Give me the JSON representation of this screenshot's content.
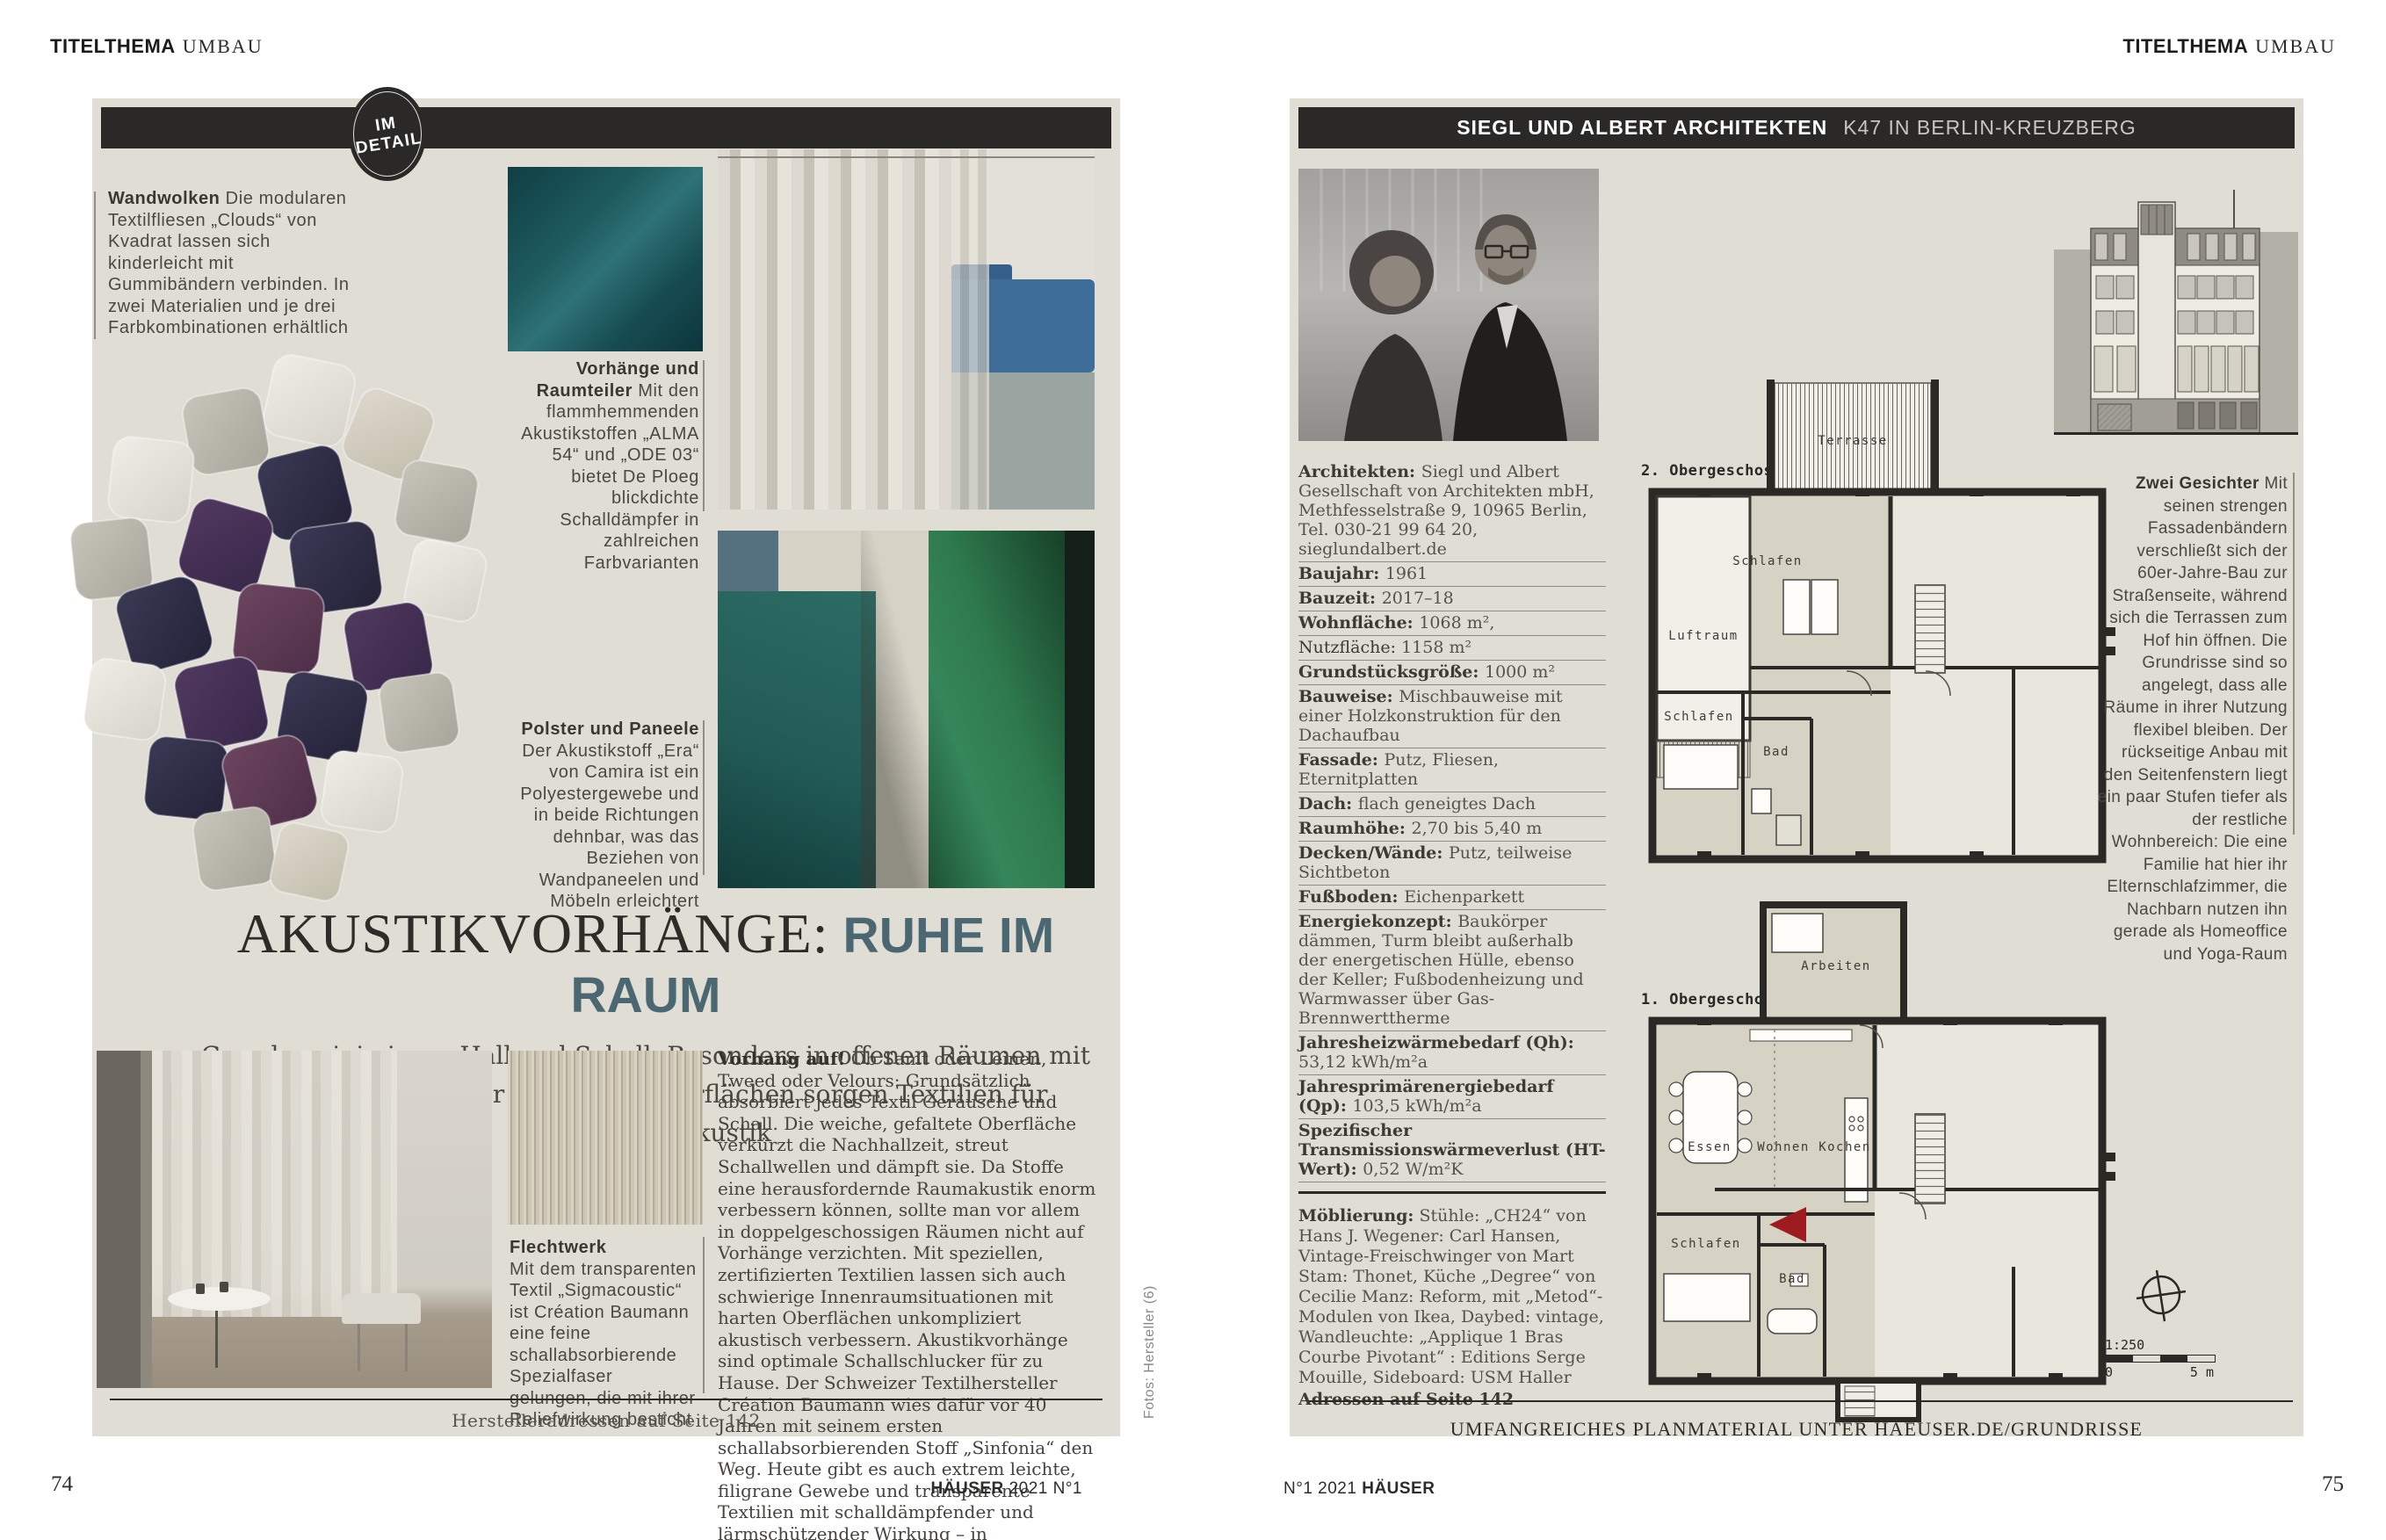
{
  "colors": {
    "panel": "#e0ddd4",
    "bar": "#2b2927",
    "headline_accent": "#4b6872",
    "arrow_red": "#9e1c20"
  },
  "page_left": {
    "kicker": {
      "bold": "TITELTHEMA",
      "light": "UMBAU"
    },
    "badge": {
      "line1": "IM",
      "line2": "DETAIL"
    },
    "captions": {
      "wandwolken": {
        "lead": "Wandwolken",
        "text": "Die modularen Textilfliesen „Clouds“ von Kvadrat lassen sich kinderleicht mit Gummibändern verbinden. In zwei Materialien und je drei Farbkombinationen erhältlich"
      },
      "vorhaenge": {
        "lead": "Vorhänge und Raumteiler",
        "text": "Mit den flammhemmenden Akustikstoffen „ALMA 54“ und „ODE 03“ bietet De Ploeg blickdichte Schalldämpfer in zahlreichen Farbvarianten"
      },
      "polster": {
        "lead": "Polster und Paneele",
        "text": "Der Akustikstoff „Era“ von Camira ist ein Polyestergewebe und in beide Richtungen dehnbar, was das Beziehen von Wandpaneelen und Möbeln erleichtert"
      },
      "flechtwerk": {
        "lead": "Flechtwerk",
        "text": "Mit dem transparenten Textil „Sigmacoustic“ ist Création Baumann eine feine schallabsorbierende Spezialfaser gelungen, die mit ihrer Reliefwirkung besticht"
      }
    },
    "headline": {
      "serif": "AKUSTIKVORHÄNGE:",
      "accent": "RUHE IM RAUM"
    },
    "standfirst": "Gewebe minimieren Hall und Schall. Besonders in offenen Räumen mit glatten Wänden oder großen Fensterflächen sorgen Textilien für erstklassige Akustik",
    "body": {
      "lead": "Vorhang auf!",
      "text": "Ob Samt oder Leinen, Tweed oder Velours: Grundsätzlich absorbiert jedes Textil Geräusche und Schall. Die weiche, gefaltete Oberfläche verkürzt die Nachhallzeit, streut Schallwellen und dämpft sie. Da Stoffe eine herausfordernde Raumakustik enorm verbessern können, sollte man vor allem in doppelgeschossigen Räumen nicht auf Vorhänge verzichten. Mit speziellen, zertifizierten Textilien lassen sich auch schwierige Innenraumsituationen mit harten Oberflächen unkompliziert akustisch verbessern. Akustikvorhänge sind optimale Schallschlucker für zu Hause. Der Schweizer Textilhersteller Création Baumann wies dafür vor 40 Jahren mit seinem ersten schallabsorbierenden Stoff „Sinfonia“ den Weg. Heute gibt es auch extrem leichte, filigrane Gewebe und transparente Textilien mit schalldämpfender und lärmschützender Wirkung – in verschiedensten Garnen, Farben, Mustern und für unterschiedliche Anwendungen."
    },
    "footer_note": "Herstelleradressen auf Seite 142",
    "credit": "Fotos: Hersteller (6)",
    "page_number": "74",
    "folio": {
      "bold": "HÄUSER",
      "rest": "2021 N°1"
    }
  },
  "page_right": {
    "kicker": {
      "bold": "TITELTHEMA",
      "light": "UMBAU"
    },
    "header": {
      "bold": "SIEGL UND ALBERT ARCHITEKTEN",
      "light": "K47 IN BERLIN-KREUZBERG"
    },
    "specs": [
      {
        "label": "Architekten:",
        "value": "Siegl und Albert Gesellschaft von Architekten mbH, Methfesselstraße 9, 10965 Berlin, Tel. 030-21 99 64 20, sieglundalbert.de"
      },
      {
        "label": "Baujahr:",
        "value": "1961"
      },
      {
        "label": "Bauzeit:",
        "value": "2017–18"
      },
      {
        "label": "Wohnfläche:",
        "value": "1068 m²,"
      },
      {
        "label": "Nutzfläche:",
        "value": "1158 m²",
        "plain": true
      },
      {
        "label": "Grundstücksgröße:",
        "value": "1000 m²"
      },
      {
        "label": "Bauweise:",
        "value": "Mischbauweise mit einer Holzkonstruktion für den Dachaufbau"
      },
      {
        "label": "Fassade:",
        "value": "Putz, Fliesen, Eternitplatten"
      },
      {
        "label": "Dach:",
        "value": "flach geneigtes Dach"
      },
      {
        "label": "Raumhöhe:",
        "value": "2,70 bis 5,40 m"
      },
      {
        "label": "Decken/Wände:",
        "value": "Putz, teilweise Sichtbeton"
      },
      {
        "label": "Fußboden:",
        "value": "Eichenparkett"
      },
      {
        "label": "Energiekonzept:",
        "value": "Baukörper dämmen, Turm bleibt außerhalb der energetischen Hülle, ebenso der Keller; Fußbodenheizung und Warmwasser über Gas-Brennwerttherme"
      },
      {
        "label": "Jahresheizwärmebedarf (Qh):",
        "value": "53,12 kWh/m²a"
      },
      {
        "label": "Jahresprimärenergiebedarf (Qp):",
        "value": "103,5 kWh/m²a"
      },
      {
        "label": "Spezifischer Transmissionswärmeverlust (HT-Wert):",
        "value": "0,52 W/m²K"
      }
    ],
    "furnishing": {
      "label": "Möblierung:",
      "text": "Stühle: „CH24“ von Hans J. Wegener: Carl Hansen, Vintage-Freischwinger von Mart Stam: Thonet, Küche „Degree“ von Cecilie Manz: Reform, mit „Metod“-Modulen von Ikea, Daybed: vintage, Wandleuchte: „Applique 1 Bras Courbe Pivotant“ : Editions Serge Mouille, Sideboard: USM Haller",
      "bold_line": "Adressen auf Seite 142"
    },
    "column": {
      "lead": "Zwei Gesichter",
      "text": "Mit seinen strengen Fassadenbändern verschließt sich der 60er-Jahre-Bau zur Straßenseite, während sich die Terrassen zum Hof hin öffnen. Die Grundrisse sind so angelegt, dass alle Räume in ihrer Nutzung flexibel bleiben. Der rückseitige Anbau mit den Seitenfenstern liegt ein paar Stufen tiefer als der restliche Wohnbereich: Die eine Familie hat hier ihr Elternschlafzimmer, die Nachbarn nutzen ihn gerade als Homeoffice und Yoga-Raum"
    },
    "plans": {
      "plan2": {
        "title": "2. Obergeschoss",
        "rooms": {
          "terrasse": "Terrasse",
          "luftraum": "Luftraum",
          "schlafen_a": "Schlafen",
          "schlafen_b": "Schlafen",
          "bad": "Bad"
        }
      },
      "plan1": {
        "title": "1. Obergeschoss",
        "rooms": {
          "arbeiten": "Arbeiten",
          "essen": "Essen",
          "wohnen": "Wohnen",
          "kochen": "Kochen",
          "schlafen": "Schlafen",
          "bad": "Bad"
        }
      },
      "scale": {
        "ratio": "1:250",
        "zero": "0",
        "five": "5 m"
      }
    },
    "footer_note": "UMFANGREICHES PLANMATERIAL UNTER HAEUSER.DE/GRUNDRISSE",
    "page_number": "75",
    "folio": {
      "rest": "N°1 2021",
      "bold": "HÄUSER"
    }
  }
}
